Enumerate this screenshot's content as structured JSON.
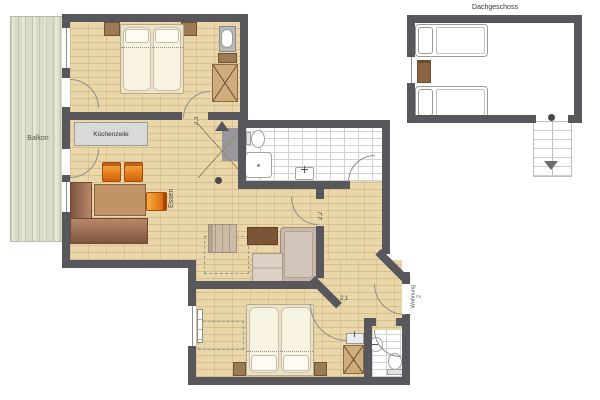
{
  "plan": {
    "labels": {
      "balcony": "Balkon",
      "kitchenette": "Küchenzeile",
      "dining": "Essen",
      "attic": "Dachgeschoss",
      "apartment_name": "Wohnung",
      "apartment_number": "2",
      "height_bedroom_top": "2,3",
      "height_hall_upper": "2,2",
      "height_hall_lower": "2,1"
    },
    "colors": {
      "wall": "#58585c",
      "wood": "#e9d7aa",
      "balcony": "#d9ddc8",
      "tileline": "#d2d2d2",
      "brown": "#9b7a55",
      "counter": "#d9d9d9",
      "chair_orange": "#e8821e"
    }
  }
}
